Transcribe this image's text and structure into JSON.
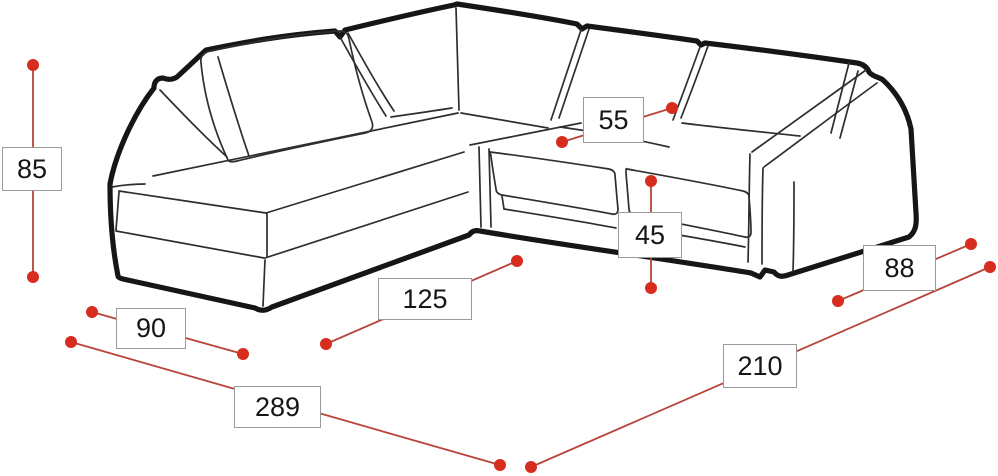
{
  "diagram": {
    "subject": "corner-sofa-dimension-drawing"
  },
  "dimensions": [
    {
      "value": "85",
      "box": {
        "x": 2,
        "y": 147,
        "w": 60,
        "h": 44
      },
      "line": {
        "x1": 33,
        "y1": 65,
        "x2": 33,
        "y2": 277
      }
    },
    {
      "value": "55",
      "box": {
        "x": 583,
        "y": 97,
        "w": 61,
        "h": 46
      },
      "line": {
        "x1": 562,
        "y1": 142,
        "x2": 672,
        "y2": 108
      }
    },
    {
      "value": "45",
      "box": {
        "x": 618,
        "y": 212,
        "w": 64,
        "h": 46
      },
      "line": {
        "x1": 651,
        "y1": 181,
        "x2": 651,
        "y2": 288
      }
    },
    {
      "value": "125",
      "box": {
        "x": 378,
        "y": 278,
        "w": 94,
        "h": 42
      },
      "line": {
        "x1": 326,
        "y1": 344,
        "x2": 517,
        "y2": 261
      }
    },
    {
      "value": "90",
      "box": {
        "x": 116,
        "y": 308,
        "w": 70,
        "h": 41
      },
      "line": {
        "x1": 92,
        "y1": 312,
        "x2": 243,
        "y2": 354
      }
    },
    {
      "value": "289",
      "box": {
        "x": 234,
        "y": 386,
        "w": 87,
        "h": 42
      },
      "line": {
        "x1": 71,
        "y1": 342,
        "x2": 500,
        "y2": 465
      }
    },
    {
      "value": "210",
      "box": {
        "x": 723,
        "y": 344,
        "w": 74,
        "h": 44
      },
      "line": {
        "x1": 531,
        "y1": 467,
        "x2": 990,
        "y2": 267
      }
    },
    {
      "value": "88",
      "box": {
        "x": 863,
        "y": 245,
        "w": 73,
        "h": 46
      },
      "line": {
        "x1": 838,
        "y1": 301,
        "x2": 971,
        "y2": 244
      }
    }
  ],
  "colors": {
    "background": "#ffffff",
    "dimension_line": "#b8443a",
    "dimension_dot": "#d72c1e",
    "label_border": "#9a9a9a",
    "label_text": "#161616",
    "sofa_outline": "#161616",
    "sofa_detail": "#2e2e2e"
  },
  "dot_radius": 6,
  "line_width": 1.8
}
